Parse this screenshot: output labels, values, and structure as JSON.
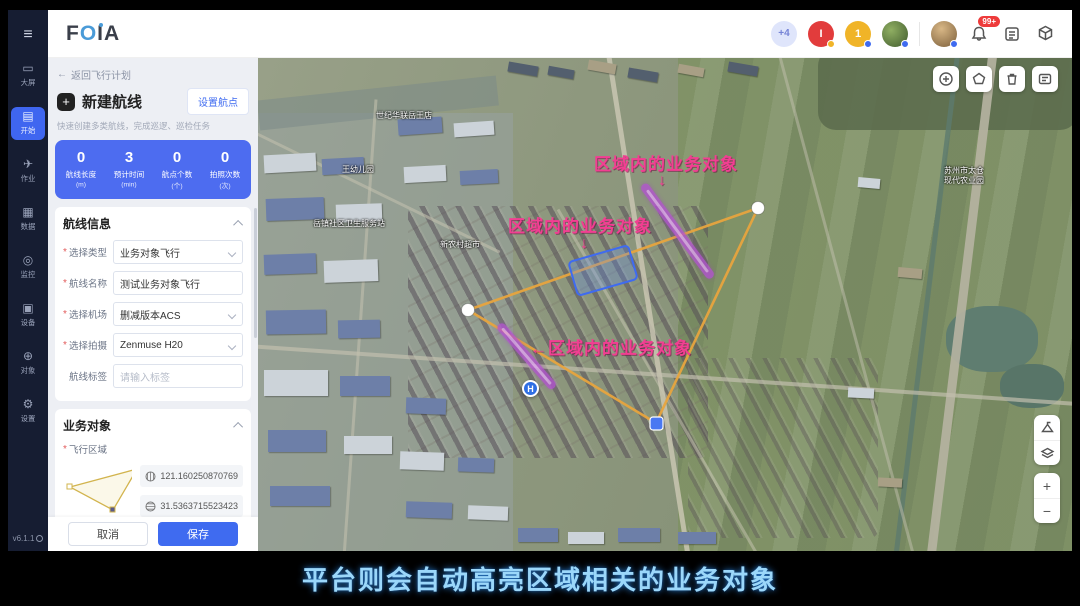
{
  "header": {
    "logo": {
      "f": "F",
      "o": "O",
      "i": "I",
      "a": "A"
    },
    "overflow_chip": "+4",
    "avatar_initials": [
      "I",
      "1"
    ],
    "notification_badge": "99+"
  },
  "sidebar": {
    "items": [
      {
        "icon": "screen-icon",
        "glyph": "▭",
        "label": "大屏"
      },
      {
        "icon": "start-icon",
        "glyph": "▤",
        "label": "开始"
      },
      {
        "icon": "jobs-icon",
        "glyph": "✈",
        "label": "作业"
      },
      {
        "icon": "data-icon",
        "glyph": "▦",
        "label": "数据"
      },
      {
        "icon": "monitor-icon",
        "glyph": "◎",
        "label": "监控"
      },
      {
        "icon": "device-icon",
        "glyph": "▣",
        "label": "设备"
      },
      {
        "icon": "objects-icon",
        "glyph": "⊕",
        "label": "对象"
      },
      {
        "icon": "settings-icon",
        "glyph": "⚙",
        "label": "设置"
      }
    ],
    "version": "v6.1.1"
  },
  "panel": {
    "back_arrow": "←",
    "back": "返回飞行计划",
    "plus": "+",
    "title": "新建航线",
    "set_waypoints": "设置航点",
    "subtitle": "快速创建多类航线，完成巡逻、巡检任务",
    "req_mark": "*",
    "stats": [
      {
        "value": "0",
        "label": "航线长度",
        "unit": "(m)"
      },
      {
        "value": "3",
        "label": "预计时间",
        "unit": "(min)"
      },
      {
        "value": "0",
        "label": "航点个数",
        "unit": "(个)"
      },
      {
        "value": "0",
        "label": "拍照次数",
        "unit": "(次)"
      }
    ],
    "route_info": {
      "title": "航线信息",
      "fields": [
        {
          "label": "选择类型",
          "value": "业务对象飞行"
        },
        {
          "label": "航线名称",
          "value": "测试业务对象飞行"
        },
        {
          "label": "选择机场",
          "value": "删减版本ACS"
        },
        {
          "label": "选择拍摄",
          "value": "Zenmuse H20"
        },
        {
          "label": "航线标签",
          "placeholder": "请输入标签"
        }
      ]
    },
    "business": {
      "title": "业务对象",
      "area_label": "飞行区域",
      "lng": "121.160250870769",
      "lat": "31.5363715523423",
      "object_label": "业务对象",
      "object_placeholder": "请选择业务对象"
    },
    "cancel": "取消",
    "save": "保存"
  },
  "map": {
    "annotations": [
      {
        "text": "区域内的业务对象",
        "arrow": "↓"
      },
      {
        "text": "区域内的业务对象",
        "arrow": "↓"
      },
      {
        "text": "←区域内的业务对象",
        "arrow": ""
      }
    ],
    "labels": [
      "世纪华联岳王店",
      "王幼儿园",
      "岳镇社区卫生服务站",
      "新农村超市",
      "苏州市太仓现代农业园"
    ],
    "helipad": "H",
    "zoom_in": "+",
    "zoom_out": "−"
  },
  "caption": "平台则会自动高亮区域相关的业务对象",
  "colors": {
    "accent": "#3f6bf0",
    "stats_bg": "#4d6cf0",
    "annotation_pink": "#f23e92",
    "flight_polygon": "#e7a43e",
    "road_highlight": "#b253cf",
    "caption_blue": "#9bd7fa"
  }
}
